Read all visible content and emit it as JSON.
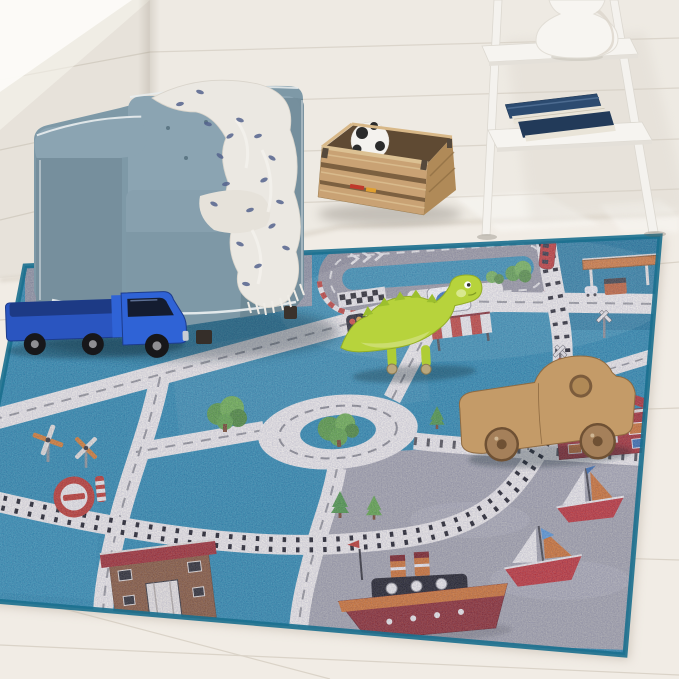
{
  "meta": {
    "type": "product-photograph",
    "subject": "kids city road-map play rug styled in a nursery corner with armchair, crate and ladder shelf"
  },
  "palette": {
    "wall_main": "#eeeae3",
    "wall_side": "#e7e2da",
    "window_light": "#fcfbf8",
    "floor_light": "#f1ece5",
    "rug_blue": "#2e8cae",
    "rug_blue_deep": "#19678a",
    "rug_binding": "#196f8e",
    "road_white": "#f2efe9",
    "track_gray": "#96959b",
    "harbor_gray": "#a7a7ab",
    "rail_dark": "#1f1f22",
    "chair_blue": "#7e99a7",
    "chair_shade": "#68828f",
    "piping_white": "#e9edee",
    "blanket_cream": "#ebe8e2",
    "blanket_navy": "#55648e",
    "crate_wood": "#c9a274",
    "crate_wood_dark": "#b08a58",
    "shelf_white": "#f4f2ee",
    "book_navy": "#2c4b70",
    "vase_white": "#f7f5f1",
    "truck_blue": "#2a55c0",
    "dino_green": "#b7d33c",
    "toy_wood": "#c49b68",
    "house_red": "#a82f2f",
    "station_brown": "#8a5a38",
    "boat_red": "#c23333",
    "accent_orange": "#d2742e",
    "sign_red": "#c0392b",
    "tree_green": "#5a9e3f"
  },
  "room": {
    "wall": "white shiplap walls meeting at a corner on the left",
    "floor": "whitewashed wood plank floor",
    "light": "window light falling from top left"
  },
  "furniture": {
    "armchair": {
      "label": "slate-blue tufted cube armchair with white piping"
    },
    "throw": {
      "label": "cream throw blanket with navy leaf pattern and fringe"
    },
    "crate": {
      "label": "natural wood slatted toy crate"
    },
    "soccer_ball": {
      "label": "black and white soccer ball inside crate"
    },
    "ladder_shelf": {
      "label": "white leaning ladder shelf"
    },
    "books": {
      "label": "stack of navy blue books"
    },
    "vase": {
      "label": "white gourd-shaped vase"
    }
  },
  "rug": {
    "label": "teal kids road-map rug with harbor",
    "features": [
      "gray race track loop with checkered start and red-white curbs",
      "white roads with dashed center lines",
      "roundabout with tree island",
      "L-shaped railroad with black ties and red tram",
      "gas station with orange canopy",
      "red house",
      "brown train station",
      "no-entry sign",
      "roundabout sign",
      "traffic light",
      "striped market awning",
      "two windmills",
      "pine and bushy trees",
      "gray harbor with tugboat and two sailboats"
    ]
  },
  "toys": [
    {
      "label": "blue toy truck"
    },
    {
      "label": "green wooden dinosaur on wheels"
    },
    {
      "label": "natural wooden toy car"
    }
  ]
}
